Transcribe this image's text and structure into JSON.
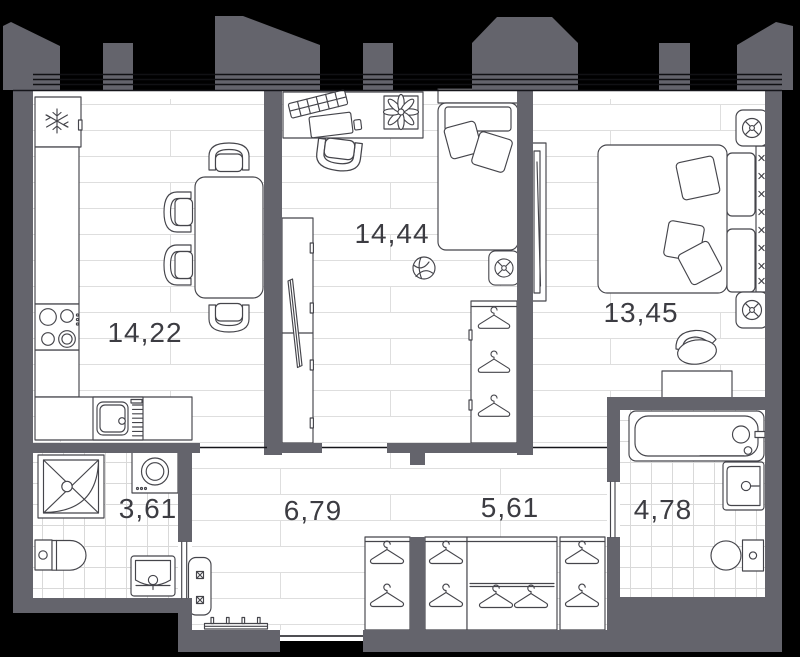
{
  "plan": {
    "name": "apartment-floor-plan",
    "rooms": [
      {
        "key": "kitchen-living",
        "label": "14,22"
      },
      {
        "key": "bedroom",
        "label": "14,44"
      },
      {
        "key": "master-bedroom",
        "label": "13,45"
      },
      {
        "key": "bathroom",
        "label": "3,61"
      },
      {
        "key": "hallway",
        "label": "6,79"
      },
      {
        "key": "corridor",
        "label": "5,61"
      },
      {
        "key": "bathroom-2",
        "label": "4,78"
      }
    ],
    "colors": {
      "background": "#000000",
      "wall": "#64646c",
      "floor": "#ffffff",
      "plank_line": "#dedede",
      "tile_line": "#d9d9d9",
      "furniture_stroke": "#45454b",
      "label_text": "#3c3c42"
    },
    "icons": [
      "snowflake-icon",
      "hanger-icon",
      "ceiling-lamp-icon",
      "shower-icon",
      "washing-machine-icon",
      "toilet-icon",
      "sink-icon",
      "bathtub-icon",
      "stove-icon",
      "dining-table-icon",
      "bed-icon",
      "desk-icon",
      "plant-icon",
      "tv-icon",
      "ball-icon",
      "bench-icon",
      "shoe-rack-icon"
    ]
  }
}
